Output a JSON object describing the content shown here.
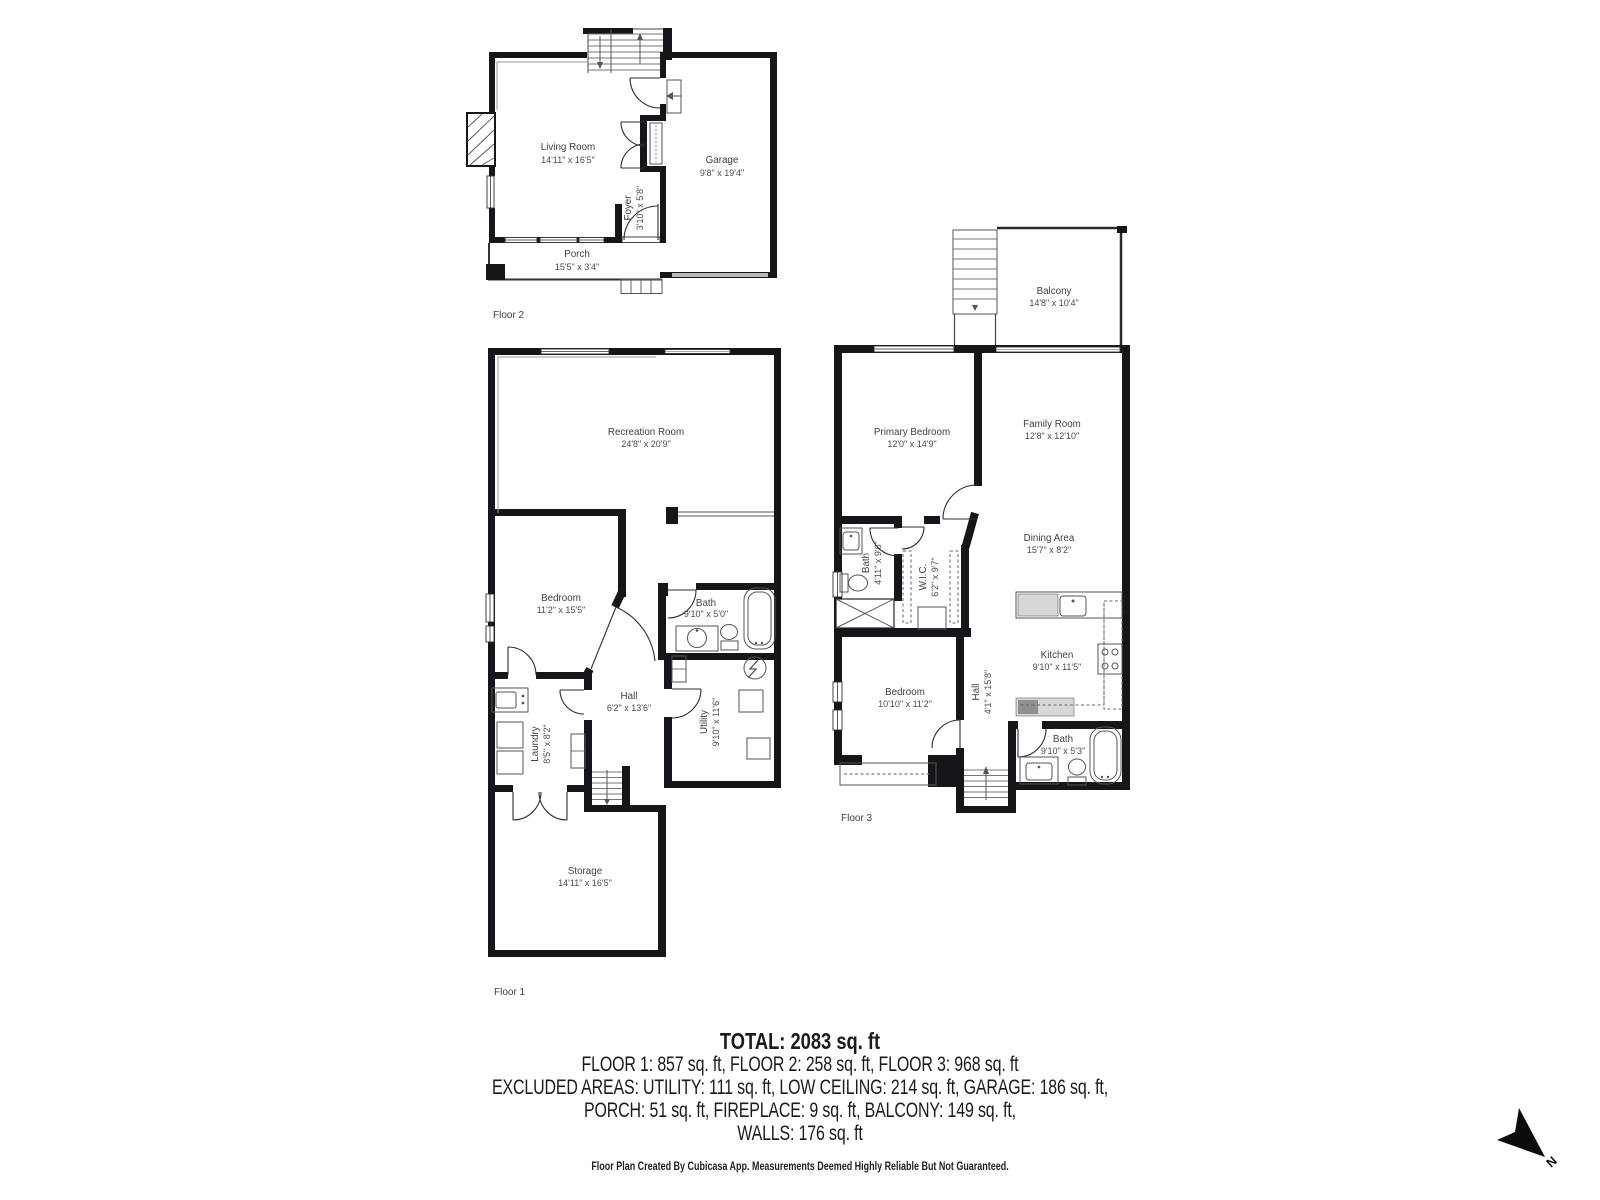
{
  "floors": {
    "floor2": {
      "label": "Floor 2",
      "rooms": {
        "living_room": {
          "name": "Living Room",
          "dims": "14'11\" x 16'5\""
        },
        "garage": {
          "name": "Garage",
          "dims": "9'8\" x 19'4\""
        },
        "foyer": {
          "name": "Foyer",
          "dims": "3'10\" x 5'8\""
        },
        "porch": {
          "name": "Porch",
          "dims": "15'5\" x 3'4\""
        }
      }
    },
    "floor1": {
      "label": "Floor 1",
      "rooms": {
        "recreation_room": {
          "name": "Recreation Room",
          "dims": "24'8\" x 20'9\""
        },
        "bedroom": {
          "name": "Bedroom",
          "dims": "11'2\" x 15'5\""
        },
        "bath": {
          "name": "Bath",
          "dims": "9'10\" x 5'0\""
        },
        "hall": {
          "name": "Hall",
          "dims": "6'2\" x 13'6\""
        },
        "laundry": {
          "name": "Laundry",
          "dims": "8'5\" x 8'2\""
        },
        "utility": {
          "name": "Utility",
          "dims": "9'10\" x 11'6\""
        },
        "storage": {
          "name": "Storage",
          "dims": "14'11\" x 16'5\""
        }
      }
    },
    "floor3": {
      "label": "Floor 3",
      "rooms": {
        "balcony": {
          "name": "Balcony",
          "dims": "14'8\" x 10'4\""
        },
        "primary_bedroom": {
          "name": "Primary Bedroom",
          "dims": "12'0\" x 14'9\""
        },
        "family_room": {
          "name": "Family Room",
          "dims": "12'8\" x 12'10\""
        },
        "bath_upper": {
          "name": "Bath",
          "dims": "4'11\" x 9'6\""
        },
        "wic": {
          "name": "W.I.C.",
          "dims": "6'2\" x 9'7\""
        },
        "dining_area": {
          "name": "Dining Area",
          "dims": "15'7\" x 8'2\""
        },
        "kitchen": {
          "name": "Kitchen",
          "dims": "9'10\" x 11'5\""
        },
        "bedroom": {
          "name": "Bedroom",
          "dims": "10'10\" x 11'2\""
        },
        "hall": {
          "name": "Hall",
          "dims": "4'1\" x 15'8\""
        },
        "bath_lower": {
          "name": "Bath",
          "dims": "9'10\" x 5'3\""
        }
      }
    }
  },
  "summary": {
    "total": "TOTAL: 2083 sq. ft",
    "floors_line": "FLOOR 1: 857 sq. ft, FLOOR 2: 258 sq. ft, FLOOR 3: 968 sq. ft",
    "excluded_line1": "EXCLUDED AREAS: UTILITY: 111 sq. ft, LOW CEILING: 214 sq. ft, GARAGE: 186 sq. ft,",
    "excluded_line2": "PORCH: 51 sq. ft, FIREPLACE: 9 sq. ft, BALCONY: 149 sq. ft,",
    "walls_line": "WALLS: 176 sq. ft"
  },
  "footer": {
    "disclaimer": "Floor Plan Created By Cubicasa App. Measurements Deemed Highly Reliable But Not Guaranteed."
  },
  "compass": {
    "north_label": "N"
  },
  "colors": {
    "wall": "#15161a",
    "label": "#3f3f3f",
    "counter_gray": "#d7d7d7",
    "garage_door_gray": "#b8b8b8"
  }
}
